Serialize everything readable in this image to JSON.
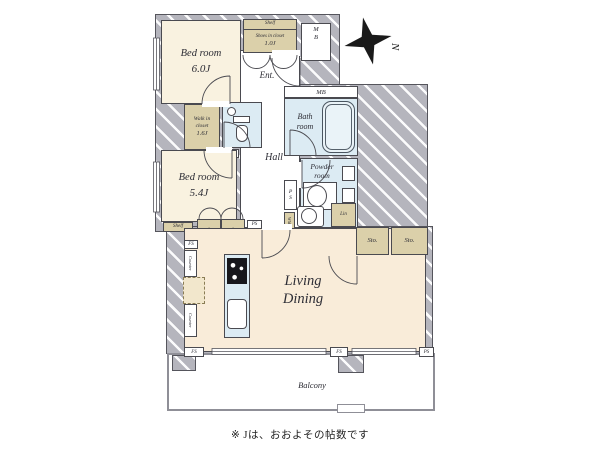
{
  "compass": {
    "north_label": "N"
  },
  "footnote": "※ Jは、おおよその帖数です",
  "colors": {
    "wall": "#b5b5bd",
    "bedroom_floor": "#f9f2e0",
    "closet": "#dbd0aa",
    "wet_area": "#dcebf3",
    "living_floor": "#f9ecd9"
  },
  "rooms": {
    "bedroom1": {
      "name": "Bed room",
      "size": "6.0J"
    },
    "bedroom2": {
      "name": "Bed room",
      "size": "5.4J"
    },
    "living_dining": {
      "line1": "Living",
      "line2": "Dining"
    },
    "hall": {
      "name": "Hall"
    },
    "entrance": {
      "name": "Ent."
    },
    "bathroom": {
      "line1": "Bath",
      "line2": "room"
    },
    "powder_room": {
      "line1": "Powder",
      "line2": "room"
    },
    "walk_in_closet": {
      "line1": "Walk in",
      "line2": "closet",
      "size": "1.6J"
    },
    "shoes_closet": {
      "shelf_label": "Shelf",
      "name": "Shoes in closet",
      "size": "1.0J"
    },
    "balcony": {
      "name": "Balcony"
    }
  },
  "tags": {
    "meter_box_letter1": "M",
    "meter_box_letter2": "B",
    "mb_strip": "MB",
    "ps": "PS",
    "ps_letter1": "P",
    "ps_letter2": "S",
    "fs": "FS",
    "wm": "WM",
    "lin": "Lin",
    "sto": "Sto.",
    "clo": "Clo.",
    "shelf": "Shelf",
    "counter": "Counter"
  }
}
